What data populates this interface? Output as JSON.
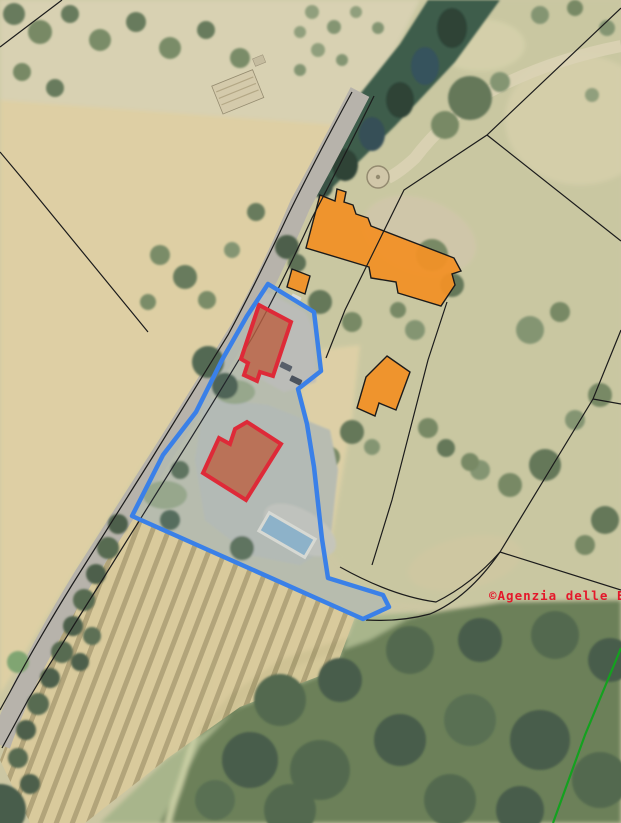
{
  "watermark": {
    "full": "©Agenzia delle En",
    "color": "#e4182b"
  },
  "overlay_colors": {
    "subject_parcel_blue": "#3a80e8",
    "highlight_building_stroke_red": "#e6202a",
    "highlight_building_fill": "#c05a33",
    "cadastral_building_orange": "#f19127",
    "cadastral_line_black": "#1b1b1b",
    "boundary_line_green": "#14a11f"
  },
  "map_summary": {
    "highlighted_buildings_count": 2,
    "orange_outlined_buildings_count": 3,
    "has_swimming_pool": true,
    "has_road": true
  }
}
